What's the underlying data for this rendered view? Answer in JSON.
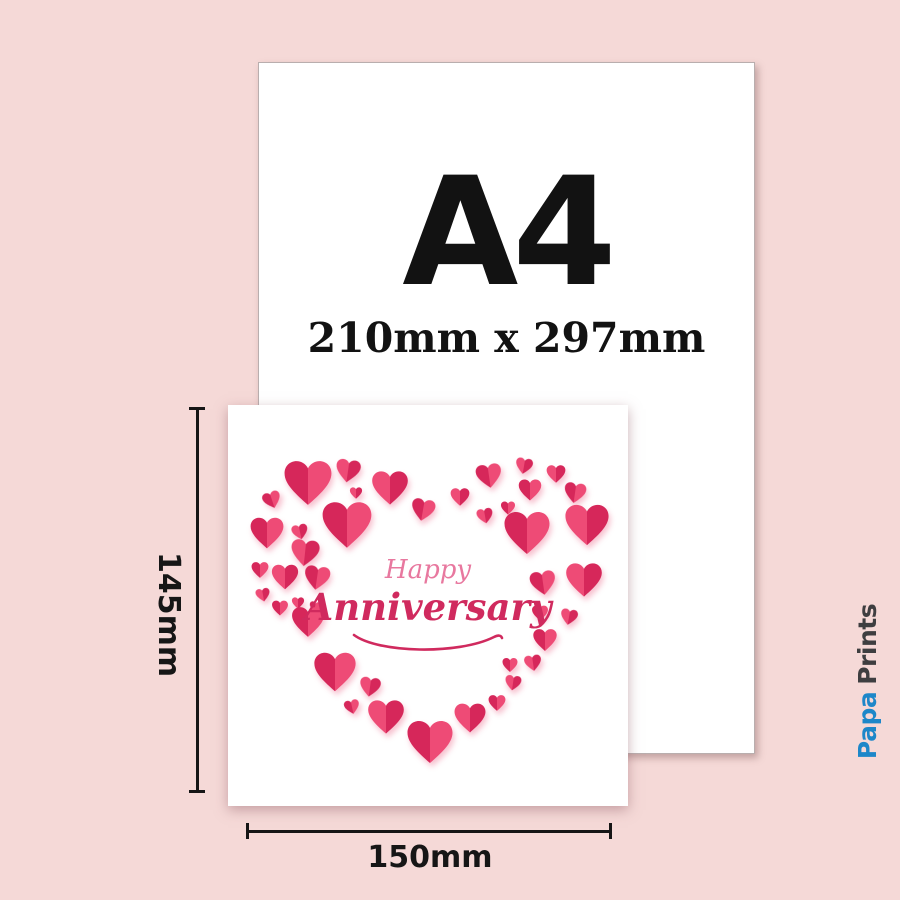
{
  "page": {
    "background_color": "#f5d9d7"
  },
  "a4_sheet": {
    "label": "A4",
    "size_text": "210mm x 297mm"
  },
  "card": {
    "greeting_word1": "Happy",
    "greeting_word2": "Anniversary",
    "greeting_color1": "#e8789f",
    "greeting_color2": "#d02a5e",
    "heart_color_dark": "#d6275a",
    "heart_color_light": "#ee4b76",
    "hearts": [
      {
        "x": 20.0,
        "y": 19.5,
        "s": 50,
        "r": 0,
        "v": "a"
      },
      {
        "x": 30.0,
        "y": 16.5,
        "s": 26,
        "r": 8,
        "v": "b"
      },
      {
        "x": 11.0,
        "y": 23.7,
        "s": 19,
        "r": -18,
        "v": "a"
      },
      {
        "x": 32.0,
        "y": 21.9,
        "s": 13,
        "r": 0,
        "v": "b"
      },
      {
        "x": 40.5,
        "y": 20.7,
        "s": 38,
        "r": 0,
        "v": "b"
      },
      {
        "x": 48.8,
        "y": 26.2,
        "s": 25,
        "r": 10,
        "v": "a"
      },
      {
        "x": 9.8,
        "y": 31.9,
        "s": 35,
        "r": 0,
        "v": "a"
      },
      {
        "x": 18.0,
        "y": 31.7,
        "s": 17,
        "r": -12,
        "v": "b"
      },
      {
        "x": 29.8,
        "y": 29.9,
        "s": 52,
        "r": 0,
        "v": "a"
      },
      {
        "x": 19.3,
        "y": 36.9,
        "s": 30,
        "r": 6,
        "v": "b"
      },
      {
        "x": 8.0,
        "y": 41.1,
        "s": 18,
        "r": 0,
        "v": "a"
      },
      {
        "x": 14.3,
        "y": 42.9,
        "s": 28,
        "r": 0,
        "v": "b"
      },
      {
        "x": 22.3,
        "y": 43.1,
        "s": 27,
        "r": 8,
        "v": "a"
      },
      {
        "x": 8.8,
        "y": 47.4,
        "s": 15,
        "r": -10,
        "v": "b"
      },
      {
        "x": 13.0,
        "y": 50.6,
        "s": 17,
        "r": 0,
        "v": "a"
      },
      {
        "x": 17.5,
        "y": 49.4,
        "s": 13,
        "r": 0,
        "v": "b"
      },
      {
        "x": 21.8,
        "y": 50.4,
        "s": 12,
        "r": 10,
        "v": "a"
      },
      {
        "x": 20.0,
        "y": 54.1,
        "s": 34,
        "r": 0,
        "v": "a"
      },
      {
        "x": 26.8,
        "y": 66.6,
        "s": 44,
        "r": 0,
        "v": "a"
      },
      {
        "x": 35.5,
        "y": 70.3,
        "s": 22,
        "r": 8,
        "v": "b"
      },
      {
        "x": 31.0,
        "y": 75.3,
        "s": 16,
        "r": -12,
        "v": "a"
      },
      {
        "x": 39.5,
        "y": 77.8,
        "s": 38,
        "r": 0,
        "v": "b"
      },
      {
        "x": 50.5,
        "y": 84.0,
        "s": 48,
        "r": 0,
        "v": "a"
      },
      {
        "x": 58.0,
        "y": 22.9,
        "s": 20,
        "r": 0,
        "v": "b"
      },
      {
        "x": 65.3,
        "y": 17.7,
        "s": 27,
        "r": -8,
        "v": "a"
      },
      {
        "x": 74.0,
        "y": 15.2,
        "s": 18,
        "r": 10,
        "v": "b"
      },
      {
        "x": 75.5,
        "y": 21.2,
        "s": 24,
        "r": 0,
        "v": "a"
      },
      {
        "x": 82.0,
        "y": 17.2,
        "s": 20,
        "r": 0,
        "v": "b"
      },
      {
        "x": 86.8,
        "y": 21.9,
        "s": 23,
        "r": 8,
        "v": "a"
      },
      {
        "x": 64.3,
        "y": 27.7,
        "s": 17,
        "r": -10,
        "v": "b"
      },
      {
        "x": 70.0,
        "y": 25.7,
        "s": 15,
        "r": 0,
        "v": "a"
      },
      {
        "x": 74.8,
        "y": 31.9,
        "s": 48,
        "r": 0,
        "v": "a"
      },
      {
        "x": 89.8,
        "y": 29.9,
        "s": 46,
        "r": 0,
        "v": "b"
      },
      {
        "x": 78.8,
        "y": 44.4,
        "s": 27,
        "r": -8,
        "v": "a"
      },
      {
        "x": 89.0,
        "y": 43.6,
        "s": 38,
        "r": 0,
        "v": "b"
      },
      {
        "x": 78.0,
        "y": 51.9,
        "s": 17,
        "r": 0,
        "v": "a"
      },
      {
        "x": 85.3,
        "y": 52.9,
        "s": 18,
        "r": 10,
        "v": "b"
      },
      {
        "x": 79.3,
        "y": 58.6,
        "s": 25,
        "r": 0,
        "v": "a"
      },
      {
        "x": 76.3,
        "y": 64.3,
        "s": 18,
        "r": -8,
        "v": "b"
      },
      {
        "x": 70.5,
        "y": 64.8,
        "s": 16,
        "r": 0,
        "v": "a"
      },
      {
        "x": 71.3,
        "y": 69.3,
        "s": 17,
        "r": 8,
        "v": "b"
      },
      {
        "x": 67.3,
        "y": 74.3,
        "s": 18,
        "r": 0,
        "v": "a"
      },
      {
        "x": 60.5,
        "y": 78.0,
        "s": 33,
        "r": 0,
        "v": "b"
      }
    ]
  },
  "dimensions": {
    "height_label": "145mm",
    "width_label": "150mm",
    "line_color": "#161616"
  },
  "logo": {
    "word1": "Papa",
    "word2": "Prints",
    "word1_color": "#1d87c9",
    "word2_color": "#3e3e40",
    "icon_color": "#1d87c9",
    "icon": "heart-chat-bubble-icon"
  }
}
